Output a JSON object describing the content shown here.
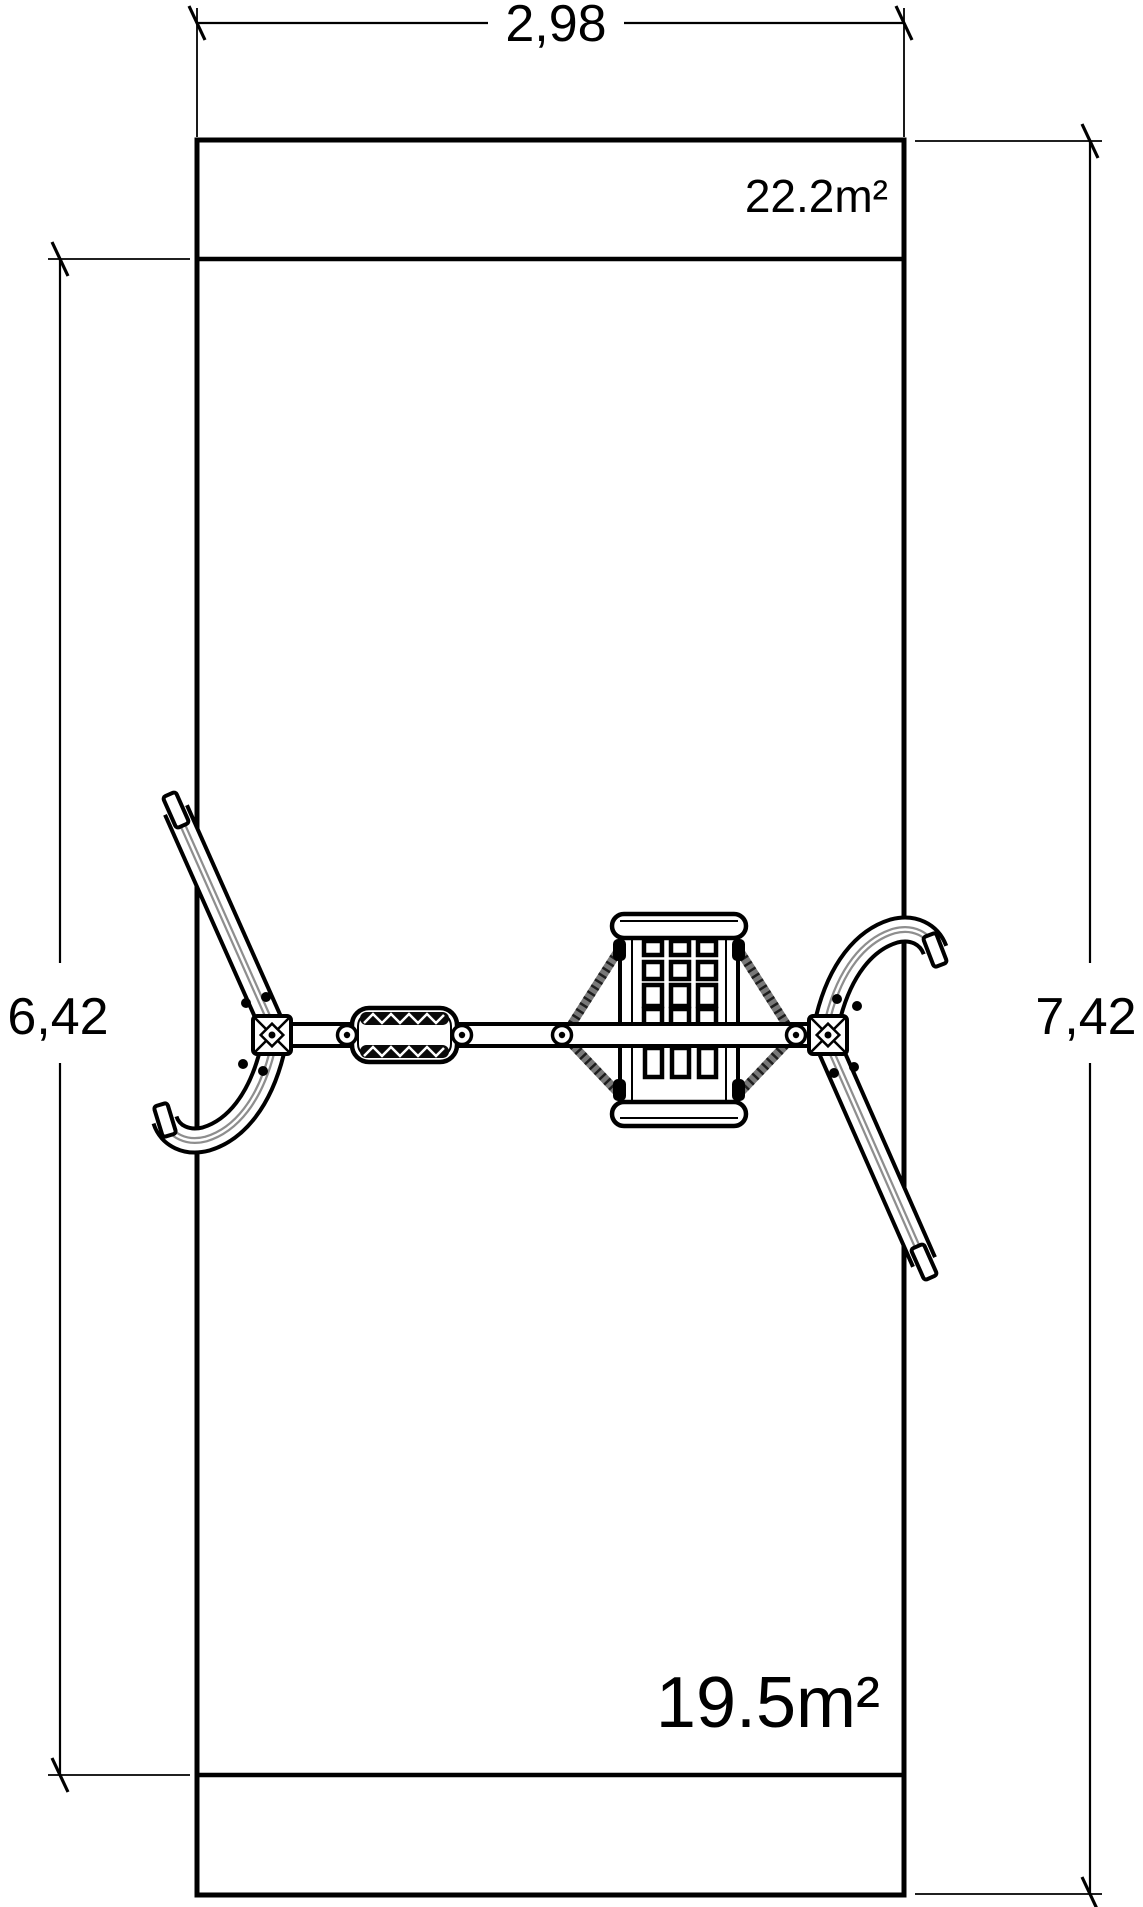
{
  "drawing": {
    "kind": "swing-set plan view with safety zones",
    "background_color": "#ffffff",
    "line_color": "#000000",
    "tube_shade_color": "#8e8e8e",
    "rope_color": "#787878"
  },
  "dimensions": {
    "top_width": "2,98",
    "left_height": "6,42",
    "right_height": "7,42"
  },
  "area_labels": {
    "upper_zone": "22.2m²",
    "lower_zone": "19.5m²"
  }
}
